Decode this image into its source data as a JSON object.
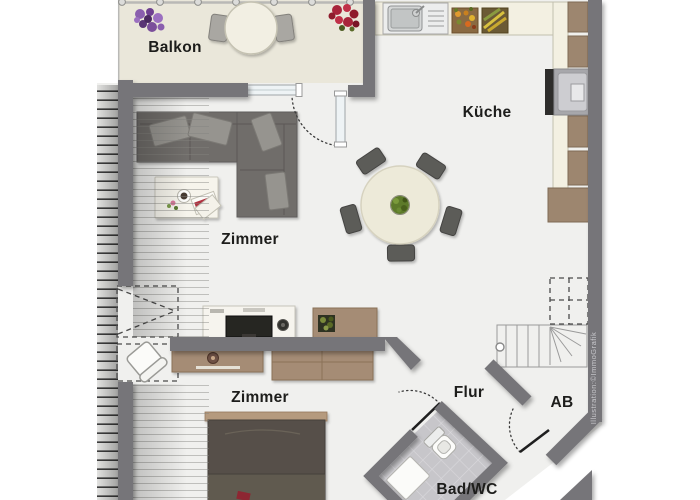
{
  "plan": {
    "type": "apartment-floorplan",
    "rooms": [
      {
        "id": "balcony",
        "label": "Balkon"
      },
      {
        "id": "kitchen",
        "label": "Küche"
      },
      {
        "id": "living-room",
        "label": "Zimmer"
      },
      {
        "id": "bedroom",
        "label": "Zimmer"
      },
      {
        "id": "hallway",
        "label": "Flur"
      },
      {
        "id": "storage",
        "label": "AB"
      },
      {
        "id": "bathroom",
        "label": "Bad/WC"
      }
    ],
    "credit": "Illustration:©ImmoGrafik",
    "colors": {
      "wall": "#767579",
      "floor": "#f0f0ee",
      "balcony_floor": "#eae7da",
      "counter": "#f3f0e2",
      "cabinet_wood": "#9d866f",
      "furniture_wood": "#a58c74",
      "sofa": "#6f6d6b",
      "bed": "#57504a",
      "bath_tile": "#c7c6ca",
      "accent_red": "#a8243a",
      "accent_purple": "#7b4f9b",
      "plant_green": "#5d7a2a"
    },
    "furniture": [
      "balcony-table",
      "balcony-chairs",
      "flower-box-purple",
      "flower-box-red",
      "kitchen-sink",
      "fruit-baskets",
      "oven",
      "kitchen-cabinets",
      "dining-table",
      "dining-chairs",
      "potted-plant",
      "corner-sofa",
      "throw-pillows",
      "coffee-table",
      "tv-sideboard",
      "tv",
      "speaker",
      "wall-shelf",
      "lowboard",
      "wardrobe",
      "double-bed",
      "desk-chair",
      "staircase",
      "toilet",
      "shower-tray"
    ]
  }
}
